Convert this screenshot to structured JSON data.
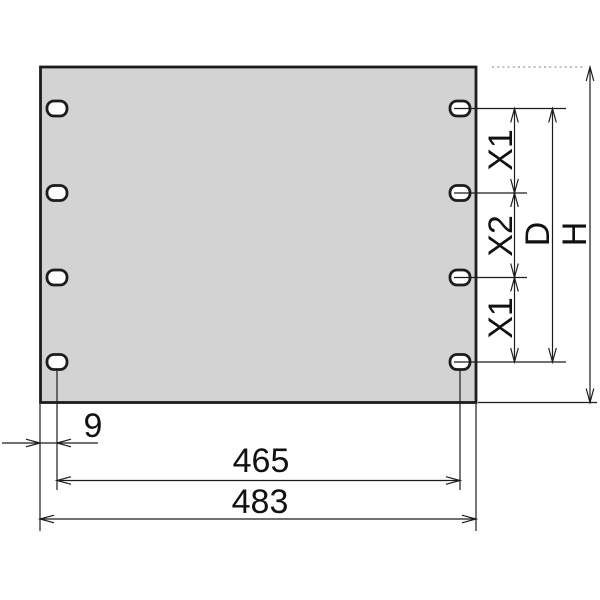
{
  "colors": {
    "background": "#ffffff",
    "line": "#1c1c1c",
    "panel_fill": "#d3d3d3",
    "hole_fill": "#ffffff",
    "dotted_line": "#9a9a9a",
    "text": "#111111"
  },
  "dimensions": {
    "x1_top": "X1",
    "x2": "X2",
    "x1_bottom": "X1",
    "hole_field_height": "D",
    "panel_height": "H",
    "edge_offset": "9",
    "hole_span": "465",
    "total_width": "483"
  }
}
